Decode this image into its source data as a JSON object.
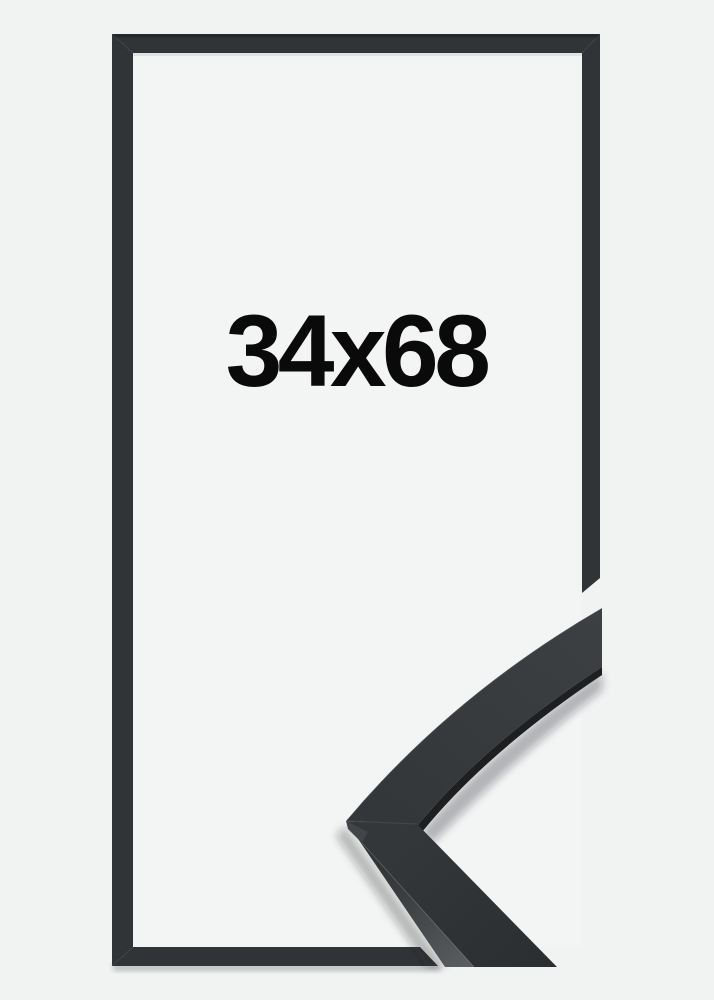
{
  "product_image": {
    "size_label": "34x68"
  },
  "colors": {
    "background": "#f1f2f2",
    "inner_background": "#f3f4f4",
    "frame_color": "#313437",
    "frame_top_shade": "#26282b",
    "label_color": "#0a0a0b",
    "arm_face_light": "#3d4043",
    "arm_face": "#34373a",
    "arm_face_dark": "#2c2f32",
    "side_facet_light": "#595c5f",
    "side_facet_mid": "#3a3d3f",
    "side_facet_dark": "#2a2c2e",
    "point_facet": "#424548",
    "lip_color": "#1d1f21"
  }
}
